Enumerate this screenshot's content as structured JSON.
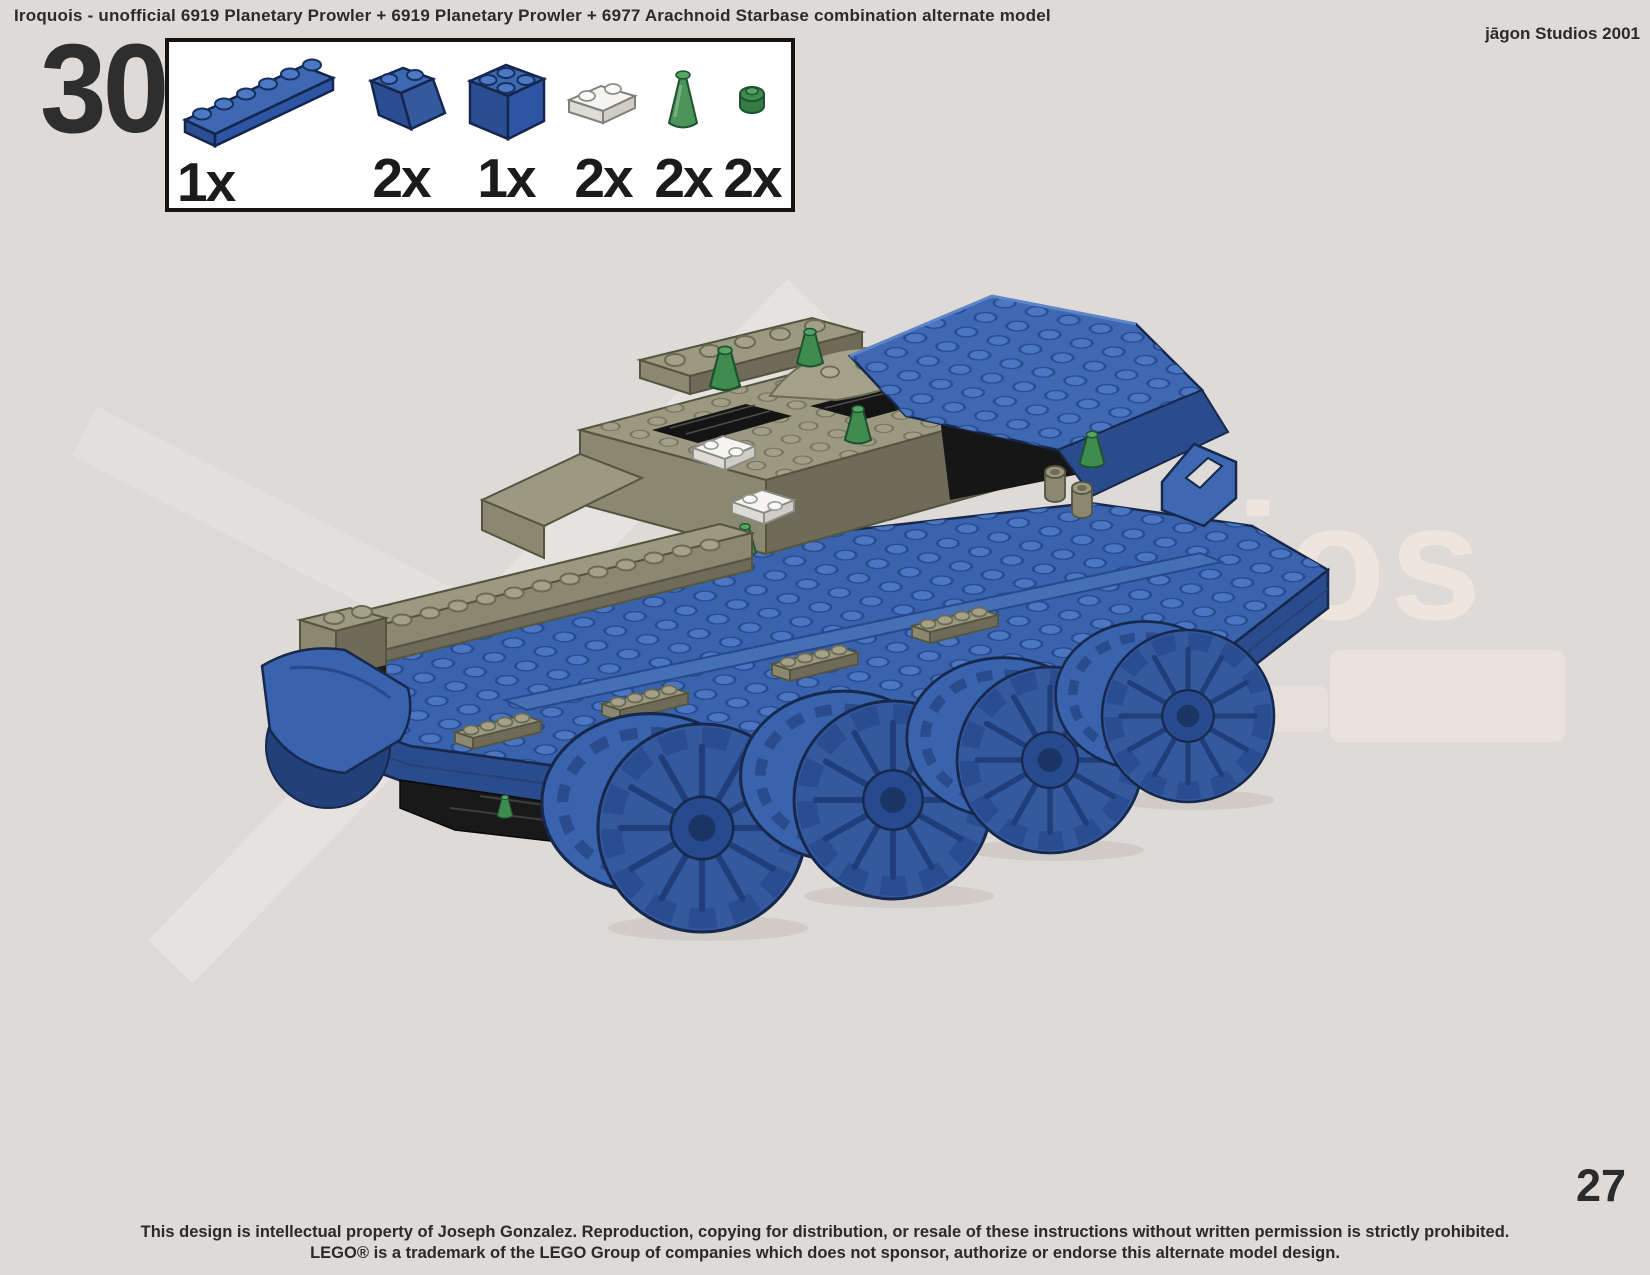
{
  "header": {
    "title": "Iroquois - unofficial 6919 Planetary Prowler + 6919 Planetary Prowler + 6977 Arachnoid Starbase combination alternate model",
    "studio_credit": "jāgon Studios 2001"
  },
  "step": {
    "number": "30"
  },
  "parts_box": {
    "parts": [
      {
        "part": "blue plate 1x6",
        "quantity": "1x",
        "color": "#3a63ae"
      },
      {
        "part": "blue slope brick 2x2",
        "quantity": "2x",
        "color": "#3a63ae"
      },
      {
        "part": "blue brick 2x2",
        "quantity": "1x",
        "color": "#3a63ae"
      },
      {
        "part": "white plate 1x2",
        "quantity": "2x",
        "color": "#f4f3f0"
      },
      {
        "part": "trans-green cone 1x1",
        "quantity": "2x",
        "color": "#3e8d4e"
      },
      {
        "part": "trans-green round plate 1x1",
        "quantity": "2x",
        "color": "#3e8d4e"
      }
    ]
  },
  "watermark": {
    "text": "ios"
  },
  "page": {
    "number": "27"
  },
  "footer": {
    "line1": "This design is intellectual property of Joseph Gonzalez.  Reproduction, copying for distribution, or resale of these instructions without written permission is strictly prohibited.",
    "line2": "LEGO® is a trademark of the LEGO Group of companies which does not sponsor, authorize or endorse this alternate model design."
  },
  "model_colors": {
    "blue": "#3a63ae",
    "olive": "#8a8870",
    "green": "#3e8d4e",
    "black": "#1d1d1d",
    "white": "#f4f3f0",
    "background": "#dedad7"
  }
}
